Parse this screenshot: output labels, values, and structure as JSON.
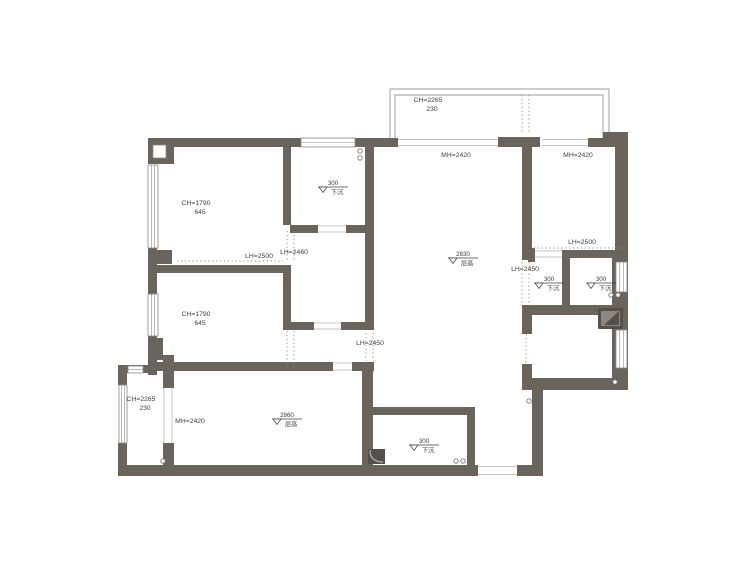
{
  "page": {
    "background": "#ffffff"
  },
  "floorplan": {
    "canvas": {
      "width": 750,
      "height": 563
    },
    "colors": {
      "wall": "#6b645d",
      "window_stroke": "#8d8a86",
      "balcony_stroke": "#b2afab",
      "door_line": "#c9c6c2",
      "dotted": "#918e8a",
      "text": "#3c3c3c",
      "circle_stroke": "#7b7873",
      "fixture_dark": "#55504a",
      "fixture_mid": "#8d8781",
      "fixture_light": "#b5b2ae",
      "niche_fill": "#ffffff"
    },
    "walls": [
      [
        148,
        138,
        154,
        9
      ],
      [
        355,
        138,
        43,
        9
      ],
      [
        498,
        137,
        42,
        10
      ],
      [
        588,
        138,
        17,
        9
      ],
      [
        603,
        132,
        25,
        15
      ],
      [
        148,
        138,
        26,
        26
      ],
      [
        148,
        248,
        9,
        46
      ],
      [
        157,
        250,
        15,
        14
      ],
      [
        148,
        336,
        9,
        39
      ],
      [
        148,
        338,
        15,
        22
      ],
      [
        163,
        355,
        11,
        33
      ],
      [
        163,
        443,
        11,
        27
      ],
      [
        118,
        365,
        39,
        8
      ],
      [
        118,
        365,
        9,
        20
      ],
      [
        118,
        443,
        9,
        33
      ],
      [
        118,
        465,
        360,
        11
      ],
      [
        517,
        465,
        26,
        11
      ],
      [
        283,
        147,
        8,
        78
      ],
      [
        290,
        225,
        28,
        8
      ],
      [
        346,
        225,
        20,
        8
      ],
      [
        365,
        138,
        9,
        192
      ],
      [
        157,
        265,
        131,
        8
      ],
      [
        283,
        265,
        8,
        65
      ],
      [
        283,
        322,
        31,
        8
      ],
      [
        341,
        322,
        33,
        8
      ],
      [
        157,
        362,
        176,
        9
      ],
      [
        352,
        362,
        22,
        9
      ],
      [
        362,
        362,
        11,
        103
      ],
      [
        373,
        407,
        102,
        8
      ],
      [
        467,
        415,
        8,
        50
      ],
      [
        522,
        137,
        10,
        123
      ],
      [
        615,
        132,
        13,
        120
      ],
      [
        612,
        252,
        16,
        138
      ],
      [
        563,
        250,
        57,
        8
      ],
      [
        562,
        250,
        8,
        57
      ],
      [
        528,
        248,
        7,
        14
      ],
      [
        522,
        305,
        106,
        10
      ],
      [
        522,
        308,
        10,
        26
      ],
      [
        522,
        364,
        10,
        26
      ],
      [
        523,
        378,
        105,
        12
      ],
      [
        532,
        390,
        11,
        75
      ]
    ],
    "niche": [
      153,
      145,
      13,
      13
    ],
    "windows": [
      [
        301,
        138,
        54,
        9
      ],
      [
        148,
        165,
        10,
        83
      ],
      [
        148,
        294,
        10,
        42
      ],
      [
        119,
        385,
        8,
        58
      ],
      [
        128,
        366,
        15,
        7
      ],
      [
        616,
        262,
        11,
        30
      ],
      [
        616,
        330,
        11,
        38
      ]
    ],
    "balcony_outlines": [
      "M390,138 L390,89 L609,89 L609,138",
      "M395,138 L395,95 L603,95 L603,138"
    ],
    "door_lines": [
      [
        398,
        139.5,
        498,
        139.5
      ],
      [
        398,
        145.5,
        498,
        145.5
      ],
      [
        542,
        139.5,
        588,
        139.5
      ],
      [
        542,
        145.5,
        588,
        145.5
      ],
      [
        318,
        226,
        346,
        226
      ],
      [
        318,
        232,
        346,
        232
      ],
      [
        314,
        323,
        341,
        323
      ],
      [
        314,
        329,
        341,
        329
      ],
      [
        333,
        363,
        352,
        363
      ],
      [
        333,
        370,
        352,
        370
      ],
      [
        164,
        388,
        164,
        443
      ],
      [
        172,
        388,
        172,
        443
      ],
      [
        478,
        466.5,
        517,
        466.5
      ],
      [
        478,
        474.5,
        517,
        474.5
      ],
      [
        535,
        251,
        562,
        251
      ],
      [
        535,
        257,
        562,
        257
      ]
    ],
    "dotted_lines": [
      [
        177,
        261,
        283,
        261
      ],
      [
        287,
        231,
        287,
        262
      ],
      [
        294,
        231,
        294,
        262
      ],
      [
        287,
        331,
        287,
        368
      ],
      [
        294,
        331,
        294,
        368
      ],
      [
        366,
        333,
        366,
        361
      ],
      [
        373,
        333,
        373,
        361
      ],
      [
        534,
        248,
        626,
        248
      ],
      [
        522,
        262,
        522,
        306
      ],
      [
        529,
        262,
        529,
        306
      ],
      [
        522,
        95,
        522,
        133
      ],
      [
        529,
        95,
        529,
        133
      ],
      [
        526,
        334,
        526,
        363
      ]
    ],
    "circles": [
      [
        360,
        151
      ],
      [
        360,
        158
      ],
      [
        611,
        295
      ],
      [
        618,
        295
      ],
      [
        615,
        382
      ],
      [
        529,
        401
      ],
      [
        456,
        461
      ],
      [
        463,
        461
      ],
      [
        163,
        461
      ]
    ],
    "fixtures": [
      {
        "type": "appliance",
        "x": 598,
        "y": 308,
        "w": 25,
        "h": 21
      },
      {
        "type": "corner-drain",
        "x": 368,
        "y": 449,
        "w": 17,
        "h": 15
      }
    ],
    "labels": [
      {
        "x": 428,
        "y": 102,
        "lines": [
          "CH=2265",
          "230"
        ]
      },
      {
        "x": 456,
        "y": 157,
        "lines": [
          "MH=2420"
        ]
      },
      {
        "x": 578,
        "y": 157,
        "lines": [
          "MH=2420"
        ]
      },
      {
        "x": 196,
        "y": 205,
        "lines": [
          "CH=1790",
          "645"
        ]
      },
      {
        "x": 259,
        "y": 258,
        "lines": [
          "LH=2500"
        ]
      },
      {
        "x": 294,
        "y": 254,
        "lines": [
          "LH=2460"
        ]
      },
      {
        "x": 582,
        "y": 244,
        "lines": [
          "LH=2500"
        ]
      },
      {
        "x": 525,
        "y": 271,
        "lines": [
          "LH=2450"
        ]
      },
      {
        "x": 196,
        "y": 316,
        "lines": [
          "CH=1790",
          "645"
        ]
      },
      {
        "x": 370,
        "y": 345,
        "lines": [
          "LH=2450"
        ]
      },
      {
        "x": 141,
        "y": 401,
        "lines": [
          "CH=2265",
          "230"
        ]
      },
      {
        "x": 190,
        "y": 423,
        "lines": [
          "MH=2420"
        ]
      }
    ],
    "level_marks": [
      {
        "x": 330,
        "y": 187,
        "value": "300",
        "caption": "下沉"
      },
      {
        "x": 460,
        "y": 258,
        "value": "2830",
        "caption": "层高"
      },
      {
        "x": 546,
        "y": 283,
        "value": "300",
        "caption": "下沉"
      },
      {
        "x": 598,
        "y": 283,
        "value": "300",
        "caption": "下沉"
      },
      {
        "x": 284,
        "y": 419,
        "value": "2860",
        "caption": "层高"
      },
      {
        "x": 421,
        "y": 445,
        "value": "300",
        "caption": "下沉"
      }
    ]
  }
}
